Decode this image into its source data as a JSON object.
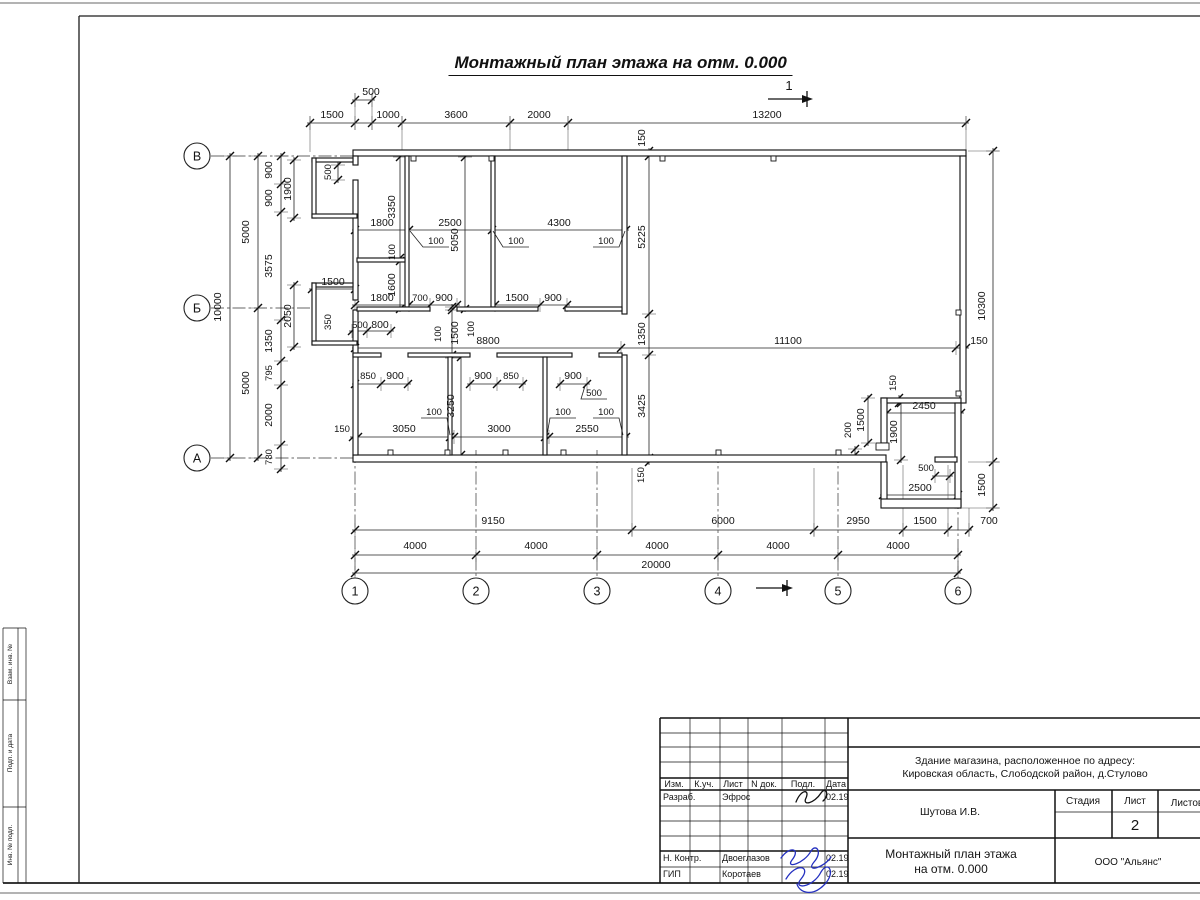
{
  "drawing_title": "Монтажный план этажа на отм. 0.000",
  "colors": {
    "ink": "#141414",
    "signature_blue": "#2430c0",
    "frame": "#1c1c1c"
  },
  "grid": {
    "rows": [
      "В",
      "Б",
      "А"
    ],
    "cols": [
      "1",
      "2",
      "3",
      "4",
      "5",
      "6"
    ]
  },
  "bubbles": [
    {
      "t": "В",
      "x": 197,
      "y": 156
    },
    {
      "t": "Б",
      "x": 197,
      "y": 308
    },
    {
      "t": "А",
      "x": 197,
      "y": 458
    },
    {
      "t": "1",
      "x": 355,
      "y": 591
    },
    {
      "t": "2",
      "x": 476,
      "y": 591
    },
    {
      "t": "3",
      "x": 597,
      "y": 591
    },
    {
      "t": "4",
      "x": 718,
      "y": 591
    },
    {
      "t": "5",
      "x": 838,
      "y": 591
    },
    {
      "t": "6",
      "x": 958,
      "y": 591
    }
  ],
  "axes": [
    {
      "x1": 211,
      "y1": 156,
      "x2": 353,
      "y2": 156
    },
    {
      "x1": 211,
      "y1": 308,
      "x2": 312,
      "y2": 308
    },
    {
      "x1": 211,
      "y1": 458,
      "x2": 353,
      "y2": 458
    },
    {
      "x1": 355,
      "y1": 450,
      "x2": 355,
      "y2": 578
    },
    {
      "x1": 476,
      "y1": 450,
      "x2": 476,
      "y2": 578
    },
    {
      "x1": 597,
      "y1": 450,
      "x2": 597,
      "y2": 578
    },
    {
      "x1": 718,
      "y1": 450,
      "x2": 718,
      "y2": 578
    },
    {
      "x1": 838,
      "y1": 450,
      "x2": 838,
      "y2": 578
    },
    {
      "x1": 958,
      "y1": 410,
      "x2": 958,
      "y2": 578
    }
  ],
  "chains": [
    {
      "o": "h",
      "y": 100,
      "xs": [
        355,
        372
      ]
    },
    {
      "o": "h",
      "y": 123,
      "xs": [
        310,
        355,
        372,
        402,
        510,
        568,
        966
      ]
    },
    {
      "o": "h",
      "y": 230,
      "xs": [
        355,
        409,
        492,
        626
      ]
    },
    {
      "o": "h",
      "y": 305,
      "xs": [
        355,
        409,
        430,
        457
      ]
    },
    {
      "o": "h",
      "y": 305,
      "xs": [
        495,
        540,
        567
      ]
    },
    {
      "o": "h",
      "y": 289,
      "xs": [
        312,
        355
      ]
    },
    {
      "o": "h",
      "y": 331,
      "xs": [
        352,
        367,
        391
      ]
    },
    {
      "o": "h",
      "y": 348,
      "xs": [
        355,
        621,
        956,
        966
      ]
    },
    {
      "o": "h",
      "y": 384,
      "xs": [
        355,
        381,
        408
      ]
    },
    {
      "o": "h",
      "y": 384,
      "xs": [
        470,
        497,
        523
      ]
    },
    {
      "o": "h",
      "y": 384,
      "xs": [
        560,
        587
      ]
    },
    {
      "o": "h",
      "y": 437,
      "xs": [
        353,
        358,
        450,
        454,
        545,
        549,
        626
      ]
    },
    {
      "o": "h",
      "y": 413,
      "xs": [
        887,
        961
      ]
    },
    {
      "o": "h",
      "y": 476,
      "xs": [
        935,
        950
      ]
    },
    {
      "o": "h",
      "y": 495,
      "xs": [
        883,
        958
      ]
    },
    {
      "o": "h",
      "y": 530,
      "xs": [
        355,
        632,
        814,
        903,
        948,
        969
      ]
    },
    {
      "o": "h",
      "y": 555,
      "xs": [
        355,
        476,
        597,
        718,
        838,
        958
      ]
    },
    {
      "o": "h",
      "y": 573,
      "xs": [
        355,
        958
      ]
    },
    {
      "o": "v",
      "x": 230,
      "ys": [
        156,
        458
      ]
    },
    {
      "o": "v",
      "x": 258,
      "ys": [
        156,
        308,
        458
      ]
    },
    {
      "o": "v",
      "x": 281,
      "ys": [
        156,
        184,
        212,
        320,
        361,
        385,
        445,
        469
      ]
    },
    {
      "o": "v",
      "x": 294,
      "ys": [
        160,
        218
      ]
    },
    {
      "o": "v",
      "x": 294,
      "ys": [
        285,
        347
      ]
    },
    {
      "o": "v",
      "x": 338,
      "ys": [
        165,
        180
      ]
    },
    {
      "o": "v",
      "x": 400,
      "ys": [
        157,
        258,
        261,
        309
      ]
    },
    {
      "o": "v",
      "x": 465,
      "ys": [
        157,
        309
      ]
    },
    {
      "o": "v",
      "x": 452,
      "ys": [
        307,
        310,
        355,
        358
      ]
    },
    {
      "o": "v",
      "x": 461,
      "ys": [
        357,
        455
      ]
    },
    {
      "o": "v",
      "x": 649,
      "ys": [
        151,
        156,
        314,
        355,
        458,
        462
      ]
    },
    {
      "o": "v",
      "x": 868,
      "ys": [
        398,
        443
      ]
    },
    {
      "o": "v",
      "x": 901,
      "ys": [
        403,
        460
      ]
    },
    {
      "o": "v",
      "x": 855,
      "ys": [
        449,
        455
      ]
    },
    {
      "o": "v",
      "x": 899,
      "ys": [
        398,
        403
      ]
    },
    {
      "o": "v",
      "x": 993,
      "ys": [
        151,
        462,
        508
      ]
    }
  ],
  "ext_lines": [
    [
      310,
      116,
      310,
      152
    ],
    [
      402,
      116,
      402,
      150
    ],
    [
      510,
      116,
      510,
      150
    ],
    [
      568,
      116,
      568,
      150
    ],
    [
      966,
      116,
      966,
      150
    ],
    [
      355,
      93,
      355,
      130
    ],
    [
      372,
      93,
      372,
      130
    ],
    [
      632,
      468,
      632,
      536
    ],
    [
      814,
      468,
      814,
      536
    ],
    [
      903,
      465,
      903,
      536
    ],
    [
      948,
      465,
      948,
      536
    ],
    [
      969,
      508,
      969,
      536
    ],
    [
      968,
      151,
      999,
      151
    ],
    [
      968,
      462,
      999,
      462
    ],
    [
      962,
      508,
      999,
      508
    ]
  ],
  "labels": [
    {
      "t": "500",
      "x": 371,
      "y": 95
    },
    {
      "t": "1500",
      "x": 332,
      "y": 118
    },
    {
      "t": "1000",
      "x": 388,
      "y": 118
    },
    {
      "t": "3600",
      "x": 456,
      "y": 118
    },
    {
      "t": "2000",
      "x": 539,
      "y": 118
    },
    {
      "t": "13200",
      "x": 767,
      "y": 118
    },
    {
      "t": "1",
      "x": 789,
      "y": 90,
      "s": 13
    },
    {
      "t": "150",
      "x": 645,
      "y": 138,
      "r": -90
    },
    {
      "t": "10000",
      "x": 221,
      "y": 307,
      "r": -90
    },
    {
      "t": "5000",
      "x": 249,
      "y": 232,
      "r": -90
    },
    {
      "t": "5000",
      "x": 249,
      "y": 383,
      "r": -90
    },
    {
      "t": "900",
      "x": 272,
      "y": 170,
      "r": -90
    },
    {
      "t": "900",
      "x": 272,
      "y": 198,
      "r": -90
    },
    {
      "t": "3575",
      "x": 272,
      "y": 266,
      "r": -90
    },
    {
      "t": "1350",
      "x": 272,
      "y": 341,
      "r": -90
    },
    {
      "t": "795",
      "x": 272,
      "y": 373,
      "r": -90,
      "s": 9.5
    },
    {
      "t": "2000",
      "x": 272,
      "y": 415,
      "r": -90
    },
    {
      "t": "780",
      "x": 272,
      "y": 457,
      "r": -90,
      "s": 9.5
    },
    {
      "t": "1900",
      "x": 291,
      "y": 189,
      "r": -90
    },
    {
      "t": "2050",
      "x": 291,
      "y": 316,
      "r": -90
    },
    {
      "t": "500",
      "x": 331,
      "y": 172,
      "r": -90,
      "s": 9.5
    },
    {
      "t": "350",
      "x": 331,
      "y": 322,
      "r": -90,
      "s": 9.5
    },
    {
      "t": "1500",
      "x": 333,
      "y": 285
    },
    {
      "t": "3350",
      "x": 395,
      "y": 207,
      "r": -90
    },
    {
      "t": "100",
      "x": 395,
      "y": 252,
      "r": -90,
      "s": 9.5
    },
    {
      "t": "1600",
      "x": 395,
      "y": 285,
      "r": -90
    },
    {
      "t": "1800",
      "x": 382,
      "y": 226
    },
    {
      "t": "2500",
      "x": 450,
      "y": 226
    },
    {
      "t": "4300",
      "x": 559,
      "y": 226
    },
    {
      "t": "100",
      "x": 436,
      "y": 244,
      "L": [
        410,
        231
      ],
      "s": 9.5
    },
    {
      "t": "100",
      "x": 516,
      "y": 244,
      "L": [
        493,
        231
      ],
      "s": 9.5
    },
    {
      "t": "100",
      "x": 606,
      "y": 244,
      "L": [
        625,
        231
      ],
      "s": 9.5
    },
    {
      "t": "5050",
      "x": 458,
      "y": 240,
      "r": -90
    },
    {
      "t": "5225",
      "x": 645,
      "y": 237,
      "r": -90
    },
    {
      "t": "1800",
      "x": 382,
      "y": 301
    },
    {
      "t": "700",
      "x": 420,
      "y": 301,
      "s": 9.5
    },
    {
      "t": "900",
      "x": 444,
      "y": 301
    },
    {
      "t": "1500",
      "x": 517,
      "y": 301
    },
    {
      "t": "900",
      "x": 553,
      "y": 301
    },
    {
      "t": "500",
      "x": 360,
      "y": 328,
      "s": 9.5
    },
    {
      "t": "800",
      "x": 380,
      "y": 328
    },
    {
      "t": "100",
      "x": 441,
      "y": 334,
      "r": -90,
      "s": 9.5
    },
    {
      "t": "1500",
      "x": 458,
      "y": 333,
      "r": -90
    },
    {
      "t": "100",
      "x": 474,
      "y": 329,
      "r": -90,
      "s": 9.5
    },
    {
      "t": "8800",
      "x": 488,
      "y": 344
    },
    {
      "t": "1350",
      "x": 645,
      "y": 334,
      "r": -90
    },
    {
      "t": "11100",
      "x": 788,
      "y": 344
    },
    {
      "t": "150",
      "x": 979,
      "y": 344
    },
    {
      "t": "850",
      "x": 368,
      "y": 379,
      "s": 9.5
    },
    {
      "t": "900",
      "x": 395,
      "y": 379
    },
    {
      "t": "900",
      "x": 483,
      "y": 379
    },
    {
      "t": "850",
      "x": 511,
      "y": 379,
      "s": 9.5
    },
    {
      "t": "900",
      "x": 573,
      "y": 379
    },
    {
      "t": "500",
      "x": 594,
      "y": 396,
      "L": [
        585,
        386
      ],
      "s": 9.5
    },
    {
      "t": "3250",
      "x": 454,
      "y": 406,
      "r": -90
    },
    {
      "t": "3425",
      "x": 645,
      "y": 406,
      "r": -90
    },
    {
      "t": "150",
      "x": 342,
      "y": 432,
      "s": 9.5
    },
    {
      "t": "3050",
      "x": 404,
      "y": 432
    },
    {
      "t": "3000",
      "x": 499,
      "y": 432
    },
    {
      "t": "2550",
      "x": 587,
      "y": 432
    },
    {
      "t": "100",
      "x": 434,
      "y": 415,
      "L": [
        450,
        435
      ],
      "s": 9.5
    },
    {
      "t": "100",
      "x": 563,
      "y": 415,
      "L": [
        547,
        435
      ],
      "s": 9.5
    },
    {
      "t": "100",
      "x": 606,
      "y": 415,
      "L": [
        623,
        435
      ],
      "s": 9.5
    },
    {
      "t": "150",
      "x": 644,
      "y": 475,
      "r": -90,
      "s": 9.5
    },
    {
      "t": "10300",
      "x": 985,
      "y": 306,
      "r": -90
    },
    {
      "t": "150",
      "x": 896,
      "y": 383,
      "r": -90,
      "s": 9.5
    },
    {
      "t": "2450",
      "x": 924,
      "y": 409
    },
    {
      "t": "1500",
      "x": 864,
      "y": 420,
      "r": -90
    },
    {
      "t": "1900",
      "x": 897,
      "y": 432,
      "r": -90
    },
    {
      "t": "200",
      "x": 851,
      "y": 430,
      "r": -90,
      "s": 9.5
    },
    {
      "t": "500",
      "x": 926,
      "y": 471,
      "s": 9.5
    },
    {
      "t": "2500",
      "x": 920,
      "y": 491
    },
    {
      "t": "1500",
      "x": 985,
      "y": 485,
      "r": -90
    },
    {
      "t": "9150",
      "x": 493,
      "y": 524
    },
    {
      "t": "6000",
      "x": 723,
      "y": 524
    },
    {
      "t": "2950",
      "x": 858,
      "y": 524
    },
    {
      "t": "1500",
      "x": 925,
      "y": 524
    },
    {
      "t": "700",
      "x": 989,
      "y": 524
    },
    {
      "t": "4000",
      "x": 415,
      "y": 549
    },
    {
      "t": "4000",
      "x": 536,
      "y": 549
    },
    {
      "t": "4000",
      "x": 657,
      "y": 549
    },
    {
      "t": "4000",
      "x": 778,
      "y": 549
    },
    {
      "t": "4000",
      "x": 898,
      "y": 549
    },
    {
      "t": "20000",
      "x": 656,
      "y": 568
    }
  ],
  "titleblock": {
    "cols": [
      "Изм.",
      "К.уч.",
      "Лист",
      "N док.",
      "Подл.",
      "Дата"
    ],
    "signature_rows": [
      {
        "role": "Разраб.",
        "name": "Эфрос",
        "date": "02.19"
      },
      {
        "role": "Н. Контр.",
        "name": "Двоеглазов",
        "date": "02.19"
      },
      {
        "role": "ГИП",
        "name": "Коротаев",
        "date": "02.19"
      }
    ],
    "project": [
      "Здание магазина, расположенное по адресу:",
      "Кировская область, Слободской район, д.Стулово"
    ],
    "author": "Шутова И.В.",
    "stage_label": "Стадия",
    "sheet_label": "Лист",
    "sheets_label": "Листов",
    "sheet_number": "2",
    "sheet_title": [
      "Монтажный план этажа",
      "на отм. 0.000"
    ],
    "company": "ООО \"Альянс\""
  },
  "left_strip_labels": [
    "Взам. инв. №",
    "Подп. и дата",
    "Инв. № подл."
  ]
}
